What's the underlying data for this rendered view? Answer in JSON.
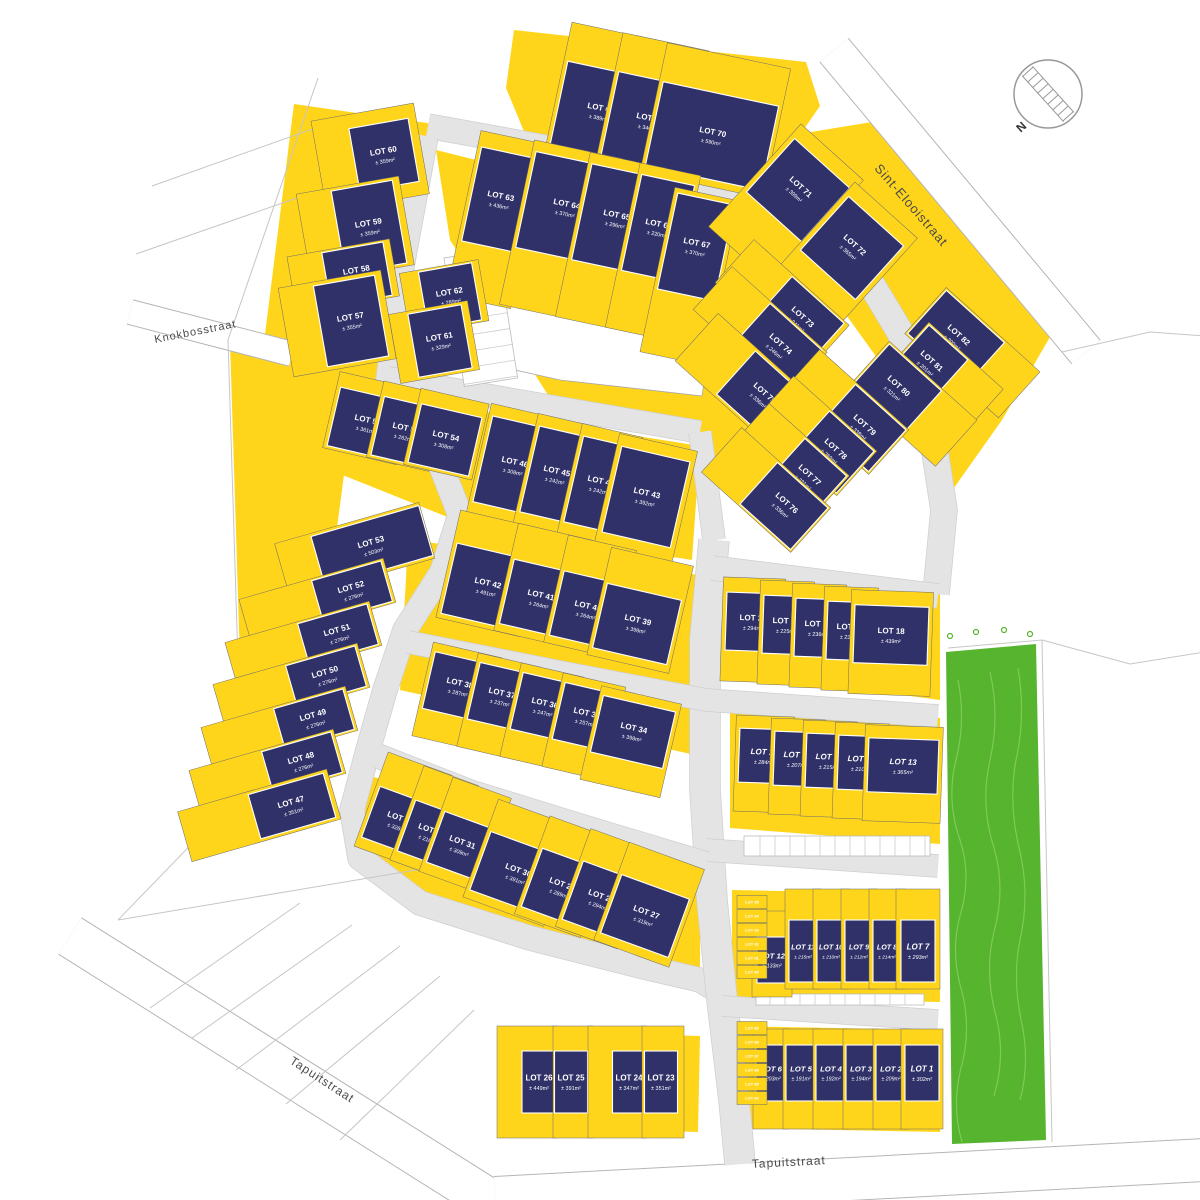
{
  "colors": {
    "parcel_yellow": "#FFD51C",
    "building_navy": "#303168",
    "road_gray": "#E4E4E4",
    "road_edge": "#CFCFCF",
    "street_white": "#FFFFFF",
    "street_edge": "#B5B5B5",
    "green_area": "#56B42E",
    "green_contour": "#7FCB58",
    "boundary_line": "#C6C6C6",
    "parcel_line": "#6B6B6B",
    "label_white": "#FFFFFF",
    "street_label": "#4A4A4A",
    "compass_stroke": "#999999"
  },
  "compass": {
    "label": "N"
  },
  "streets": [
    {
      "name": "Sint-Elooistraat",
      "x": 908,
      "y": 208,
      "angle": 49,
      "size": 13
    },
    {
      "name": "Knokbosstraat",
      "x": 196,
      "y": 335,
      "angle": -11,
      "size": 11
    },
    {
      "name": "Tapuitstraat",
      "x": 320,
      "y": 1083,
      "angle": 33,
      "size": 12
    },
    {
      "name": "Tapuitstraat",
      "x": 789,
      "y": 1166,
      "angle": -3,
      "size": 12
    }
  ],
  "blocks": [
    {
      "angle": 12,
      "ph": 132,
      "dy": -16,
      "lots": [
        {
          "n": "LOT 68",
          "area": "± 389m²",
          "cx": 600,
          "cy": 112,
          "bw": 84,
          "bh": 86,
          "pw": 92
        },
        {
          "n": "LOT 69",
          "area": "± 346m²",
          "cx": 649,
          "cy": 122,
          "bw": 80,
          "bh": 86,
          "pw": 88
        },
        {
          "n": "LOT 70",
          "area": "± 590m²",
          "cx": 712,
          "cy": 136,
          "bw": 118,
          "bh": 86,
          "pw": 126
        }
      ]
    },
    {
      "angle": -10,
      "dx": -14,
      "lots": [
        {
          "n": "LOT 60",
          "area": "± 359m²",
          "cx": 384,
          "cy": 155,
          "bw": 60,
          "bh": 64,
          "pw": 104,
          "ph": 92
        },
        {
          "n": "LOT 59",
          "area": "± 359m²",
          "cx": 369,
          "cy": 227,
          "bw": 62,
          "bh": 84,
          "pw": 104,
          "ph": 90
        },
        {
          "n": "LOT 58",
          "area": "± 271m²",
          "cx": 357,
          "cy": 274,
          "bw": 62,
          "bh": 54,
          "pw": 104,
          "ph": 58
        },
        {
          "n": "LOT 57",
          "area": "± 355m²",
          "cx": 351,
          "cy": 321,
          "bw": 62,
          "bh": 82,
          "pw": 104,
          "ph": 90
        }
      ]
    },
    {
      "angle": 12,
      "ph": 168,
      "lots": [
        {
          "n": "LOT 63",
          "area": "± 436m²",
          "cx": 500,
          "cy": 200,
          "bw": 58,
          "bh": 96,
          "pw": 66,
          "dy": 20
        },
        {
          "n": "LOT 64",
          "area": "± 370m²",
          "cx": 566,
          "cy": 208,
          "bw": 82,
          "bh": 98,
          "pw": 90,
          "dy": 24
        },
        {
          "n": "LOT 65",
          "area": "± 296m²",
          "cx": 616,
          "cy": 219,
          "bw": 70,
          "bh": 98,
          "pw": 78,
          "dy": 24
        },
        {
          "n": "LOT 66",
          "area": "± 220m²",
          "cx": 658,
          "cy": 228,
          "bw": 54,
          "bh": 98,
          "pw": 62,
          "dy": 24
        },
        {
          "n": "LOT 67",
          "area": "± 370m²",
          "cx": 696,
          "cy": 247,
          "bw": 58,
          "bh": 98,
          "pw": 66,
          "dy": 30
        }
      ]
    },
    {
      "angle": -10,
      "dx": -6,
      "lots": [
        {
          "n": "LOT 62",
          "area": "± 289m²",
          "cx": 450,
          "cy": 296,
          "bw": 54,
          "bh": 58,
          "pw": 80,
          "ph": 62
        },
        {
          "n": "LOT 61",
          "area": "± 329m²",
          "cx": 440,
          "cy": 341,
          "bw": 54,
          "bh": 64,
          "pw": 80,
          "ph": 70
        }
      ]
    },
    {
      "angle": 42,
      "dy": 18,
      "ph": 138,
      "lots": [
        {
          "n": "LOT 71",
          "area": "± 399m²",
          "cx": 798,
          "cy": 190,
          "bw": 74,
          "bh": 72,
          "pw": 84
        },
        {
          "n": "LOT 72",
          "area": "± 365m²",
          "cx": 852,
          "cy": 248,
          "bw": 74,
          "bh": 72,
          "pw": 84
        }
      ]
    },
    {
      "angle": 42,
      "dx": -24,
      "lots": [
        {
          "n": "LOT 73",
          "area": "± 341m²",
          "cx": 800,
          "cy": 320,
          "bw": 70,
          "bh": 54,
          "pw": 128,
          "ph": 58
        },
        {
          "n": "LOT 74",
          "area": "± 246m²",
          "cx": 778,
          "cy": 347,
          "bw": 70,
          "bh": 54,
          "pw": 128,
          "ph": 58
        },
        {
          "n": "LOT 75",
          "area": "± 336m²",
          "cx": 762,
          "cy": 396,
          "bw": 70,
          "bh": 58,
          "pw": 128,
          "ph": 64
        }
      ]
    },
    {
      "angle": 42,
      "dx": 22,
      "ph": 62,
      "lots": [
        {
          "n": "LOT 82",
          "area": "± 390m²",
          "cx": 956,
          "cy": 338,
          "bw": 78,
          "bh": 58,
          "pw": 126
        },
        {
          "n": "LOT 81",
          "area": "± 201m²",
          "cx": 929,
          "cy": 364,
          "bw": 52,
          "bh": 58,
          "pw": 100
        },
        {
          "n": "LOT 80",
          "area": "± 321m²",
          "cx": 896,
          "cy": 389,
          "bw": 70,
          "bh": 58,
          "pw": 118
        }
      ]
    },
    {
      "angle": 42,
      "dx": -24,
      "ph": 60,
      "lots": [
        {
          "n": "LOT 79",
          "area": "± 338m²",
          "cx": 862,
          "cy": 428,
          "bw": 68,
          "bh": 56,
          "pw": 120
        },
        {
          "n": "LOT 78",
          "area": "± 269m²",
          "cx": 833,
          "cy": 452,
          "bw": 60,
          "bh": 56,
          "pw": 112
        },
        {
          "n": "LOT 77",
          "area": "± 231m²",
          "cx": 807,
          "cy": 478,
          "bw": 56,
          "bh": 56,
          "pw": 108
        },
        {
          "n": "LOT 76",
          "area": "± 336m²",
          "cx": 784,
          "cy": 506,
          "bw": 68,
          "bh": 56,
          "pw": 120
        }
      ]
    },
    {
      "angle": 13,
      "dy": -6,
      "ph": 78,
      "lots": [
        {
          "n": "LOT 56",
          "area": "± 361m²",
          "cx": 367,
          "cy": 424,
          "bw": 68,
          "bh": 60,
          "pw": 76
        },
        {
          "n": "LOT 55",
          "area": "± 262m²",
          "cx": 405,
          "cy": 432,
          "bw": 56,
          "bh": 60,
          "pw": 64
        },
        {
          "n": "LOT 54",
          "area": "± 308m²",
          "cx": 445,
          "cy": 440,
          "bw": 62,
          "bh": 60,
          "pw": 70
        }
      ]
    },
    {
      "angle": 13,
      "dy": 14,
      "ph": 140,
      "lots": [
        {
          "n": "LOT 46",
          "area": "± 308m²",
          "cx": 514,
          "cy": 466,
          "bw": 64,
          "bh": 88,
          "pw": 72
        },
        {
          "n": "LOT 45",
          "area": "± 242m²",
          "cx": 556,
          "cy": 475,
          "bw": 54,
          "bh": 88,
          "pw": 62
        },
        {
          "n": "LOT 44",
          "area": "± 242m²",
          "cx": 600,
          "cy": 485,
          "bw": 54,
          "bh": 88,
          "pw": 62
        },
        {
          "n": "LOT 43",
          "area": "± 392m²",
          "cx": 646,
          "cy": 497,
          "bw": 70,
          "bh": 88,
          "pw": 80
        }
      ]
    },
    {
      "angle": -16,
      "lots": [
        {
          "n": "LOT 53",
          "area": "± 503m²",
          "cx": 372,
          "cy": 546,
          "bw": 112,
          "bh": 52,
          "pw": 150,
          "ph": 58,
          "dx": -18
        }
      ]
    },
    {
      "angle": -16,
      "dx": -36,
      "ph": 46,
      "lots": [
        {
          "n": "LOT 52",
          "area": "± 276m²",
          "cx": 352,
          "cy": 591,
          "bw": 72,
          "bh": 42,
          "pw": 150
        },
        {
          "n": "LOT 51",
          "area": "± 276m²",
          "cx": 338,
          "cy": 634,
          "bw": 72,
          "bh": 42,
          "pw": 150
        },
        {
          "n": "LOT 50",
          "area": "± 276m²",
          "cx": 326,
          "cy": 676,
          "bw": 72,
          "bh": 42,
          "pw": 150
        },
        {
          "n": "LOT 49",
          "area": "± 276m²",
          "cx": 314,
          "cy": 719,
          "bw": 72,
          "bh": 42,
          "pw": 150
        },
        {
          "n": "LOT 48",
          "area": "± 276m²",
          "cx": 302,
          "cy": 762,
          "bw": 72,
          "bh": 42,
          "pw": 150
        },
        {
          "n": "LOT 47",
          "area": "± 351m²",
          "cx": 292,
          "cy": 806,
          "bw": 78,
          "bh": 46,
          "pw": 155,
          "ph": 52,
          "dx": -34
        }
      ]
    },
    {
      "angle": 13,
      "dy": -14,
      "ph": 110,
      "lots": [
        {
          "n": "LOT 42",
          "area": "± 491m²",
          "cx": 487,
          "cy": 587,
          "bw": 78,
          "bh": 72,
          "pw": 86
        },
        {
          "n": "LOT 41",
          "area": "± 264m²",
          "cx": 540,
          "cy": 599,
          "bw": 68,
          "bh": 66,
          "pw": 76
        },
        {
          "n": "LOT 40",
          "area": "± 264m²",
          "cx": 587,
          "cy": 610,
          "bw": 62,
          "bh": 66,
          "pw": 70
        },
        {
          "n": "LOT 39",
          "area": "± 398m²",
          "cx": 637,
          "cy": 624,
          "bw": 76,
          "bh": 66,
          "pw": 84
        }
      ]
    },
    {
      "angle": 13,
      "dy": 10,
      "ph": 96,
      "lots": [
        {
          "n": "LOT 38",
          "area": "± 287m²",
          "cx": 459,
          "cy": 687,
          "bw": 62,
          "bh": 58,
          "pw": 70
        },
        {
          "n": "LOT 37",
          "area": "± 237m²",
          "cx": 501,
          "cy": 697,
          "bw": 56,
          "bh": 58,
          "pw": 64
        },
        {
          "n": "LOT 36",
          "area": "± 247m²",
          "cx": 544,
          "cy": 707,
          "bw": 56,
          "bh": 58,
          "pw": 64
        },
        {
          "n": "LOT 35",
          "area": "± 257m²",
          "cx": 586,
          "cy": 717,
          "bw": 56,
          "bh": 58,
          "pw": 64
        },
        {
          "n": "LOT 34",
          "area": "± 398m²",
          "cx": 633,
          "cy": 732,
          "bw": 74,
          "bh": 58,
          "pw": 82
        }
      ]
    },
    {
      "angle": 2,
      "dy": 8,
      "ph": 104,
      "lots": [
        {
          "n": "LOT 22",
          "area": "± 294m²",
          "cx": 753,
          "cy": 622,
          "bw": 54,
          "bh": 58,
          "pw": 62
        },
        {
          "n": "LOT 21",
          "area": "± 225m²",
          "cx": 786,
          "cy": 625,
          "bw": 46,
          "bh": 58,
          "pw": 54
        },
        {
          "n": "LOT 20",
          "area": "± 236m²",
          "cx": 818,
          "cy": 628,
          "bw": 46,
          "bh": 58,
          "pw": 54
        },
        {
          "n": "LOT 19",
          "area": "± 238m²",
          "cx": 850,
          "cy": 631,
          "bw": 46,
          "bh": 58,
          "pw": 54
        },
        {
          "n": "LOT 18",
          "area": "± 439m²",
          "cx": 891,
          "cy": 635,
          "bw": 74,
          "bh": 58,
          "pw": 82
        }
      ]
    },
    {
      "angle": 2,
      "it": 1,
      "dy": 8,
      "ph": 96,
      "lots": [
        {
          "n": "LOT 17",
          "area": "± 284m²",
          "cx": 764,
          "cy": 756,
          "bw": 50,
          "bh": 54,
          "pw": 58
        },
        {
          "n": "LOT 16",
          "area": "± 207m²",
          "cx": 797,
          "cy": 759,
          "bw": 46,
          "bh": 54,
          "pw": 54
        },
        {
          "n": "LOT 15",
          "area": "± 215m²",
          "cx": 829,
          "cy": 761,
          "bw": 46,
          "bh": 54,
          "pw": 54
        },
        {
          "n": "LOT 14",
          "area": "± 210m²",
          "cx": 861,
          "cy": 763,
          "bw": 46,
          "bh": 54,
          "pw": 54
        },
        {
          "n": "LOT 13",
          "area": "± 365m²",
          "cx": 903,
          "cy": 766,
          "bw": 70,
          "bh": 54,
          "pw": 78
        }
      ]
    },
    {
      "angle": 20,
      "dy": -12,
      "ph": 100,
      "lots": [
        {
          "n": "LOT 33",
          "area": "± 326m²",
          "cx": 399,
          "cy": 822,
          "bw": 60,
          "bh": 54,
          "pw": 68
        },
        {
          "n": "LOT 32",
          "area": "± 216m²",
          "cx": 430,
          "cy": 834,
          "bw": 50,
          "bh": 54,
          "pw": 58
        },
        {
          "n": "LOT 31",
          "area": "± 309m²",
          "cx": 461,
          "cy": 846,
          "bw": 54,
          "bh": 54,
          "pw": 62
        }
      ]
    },
    {
      "angle": 20,
      "dy": -12,
      "ph": 104,
      "lots": [
        {
          "n": "LOT 30",
          "area": "± 391m²",
          "cx": 517,
          "cy": 874,
          "bw": 78,
          "bh": 62,
          "pw": 86
        },
        {
          "n": "LOT 29",
          "area": "± 289m²",
          "cx": 561,
          "cy": 888,
          "bw": 62,
          "bh": 62,
          "pw": 70
        },
        {
          "n": "LOT 28",
          "area": "± 294m²",
          "cx": 600,
          "cy": 900,
          "bw": 58,
          "bh": 62,
          "pw": 66
        },
        {
          "n": "LOT 27",
          "area": "± 319m²",
          "cx": 645,
          "cy": 916,
          "bw": 72,
          "bh": 62,
          "pw": 80
        }
      ]
    },
    {
      "angle": 0,
      "it": 1,
      "dy": -12,
      "ph": 100,
      "lots": [
        {
          "n": "LOT 12",
          "area": "± 133m²",
          "cx": 772,
          "cy": 960,
          "bw": 30,
          "bh": 46,
          "pw": 40,
          "ph": 86,
          "dy": -6
        },
        {
          "n": "LOT 11",
          "area": "± 215m²",
          "cx": 803,
          "cy": 951,
          "bw": 28,
          "bh": 62,
          "pw": 36
        },
        {
          "n": "LOT 10",
          "area": "± 210m²",
          "cx": 831,
          "cy": 951,
          "bw": 28,
          "bh": 62,
          "pw": 36
        },
        {
          "n": "LOT 9",
          "area": "± 212m²",
          "cx": 859,
          "cy": 951,
          "bw": 28,
          "bh": 62,
          "pw": 36
        },
        {
          "n": "LOT 8",
          "area": "± 214m²",
          "cx": 887,
          "cy": 951,
          "bw": 28,
          "bh": 62,
          "pw": 36
        },
        {
          "n": "LOT 7",
          "area": "± 293m²",
          "cx": 918,
          "cy": 951,
          "bw": 34,
          "bh": 62,
          "pw": 44
        }
      ]
    },
    {
      "angle": 0,
      "ph": 112,
      "lots": [
        {
          "n": "LOT 26",
          "area": "± 449m²",
          "cx": 539,
          "cy": 1082,
          "bw": 34,
          "bh": 62,
          "pw": 60,
          "dx": -12
        },
        {
          "n": "LOT 25",
          "area": "± 391m²",
          "cx": 571,
          "cy": 1082,
          "bw": 33,
          "bh": 62,
          "pw": 40,
          "dx": 2
        },
        {
          "n": "LOT 24",
          "area": "± 347m²",
          "cx": 629,
          "cy": 1082,
          "bw": 33,
          "bh": 62,
          "pw": 58,
          "dx": -12
        },
        {
          "n": "LOT 23",
          "area": "± 351m²",
          "cx": 661,
          "cy": 1082,
          "bw": 33,
          "bh": 62,
          "pw": 42,
          "dx": 2
        }
      ]
    },
    {
      "angle": 0,
      "it": 1,
      "dy": 6,
      "ph": 100,
      "lots": [
        {
          "n": "LOT 6",
          "area": "± 203m²",
          "cx": 771,
          "cy": 1073,
          "bw": 30,
          "bh": 56,
          "pw": 36
        },
        {
          "n": "LOT 5",
          "area": "± 191m²",
          "cx": 801,
          "cy": 1073,
          "bw": 30,
          "bh": 56,
          "pw": 36
        },
        {
          "n": "LOT 4",
          "area": "± 192m²",
          "cx": 831,
          "cy": 1073,
          "bw": 30,
          "bh": 56,
          "pw": 36
        },
        {
          "n": "LOT 3",
          "area": "± 194m²",
          "cx": 861,
          "cy": 1073,
          "bw": 30,
          "bh": 56,
          "pw": 36
        },
        {
          "n": "LOT 2",
          "area": "± 209m²",
          "cx": 891,
          "cy": 1073,
          "bw": 30,
          "bh": 56,
          "pw": 36
        },
        {
          "n": "LOT 1",
          "area": "± 302m²",
          "cx": 922,
          "cy": 1073,
          "bw": 34,
          "bh": 56,
          "pw": 42
        }
      ]
    }
  ],
  "garages": [
    {
      "n": "LOT 95",
      "cx": 752,
      "cy": 902
    },
    {
      "n": "LOT 94",
      "cx": 752,
      "cy": 916
    },
    {
      "n": "LOT 93",
      "cx": 752,
      "cy": 930
    },
    {
      "n": "LOT 92",
      "cx": 752,
      "cy": 944
    },
    {
      "n": "LOT 91",
      "cx": 752,
      "cy": 958
    },
    {
      "n": "LOT 90",
      "cx": 752,
      "cy": 972
    },
    {
      "n": "LOT 89",
      "cx": 752,
      "cy": 1028
    },
    {
      "n": "LOT 88",
      "cx": 752,
      "cy": 1042
    },
    {
      "n": "LOT 87",
      "cx": 752,
      "cy": 1056
    },
    {
      "n": "LOT 86",
      "cx": 752,
      "cy": 1070
    },
    {
      "n": "LOT 85",
      "cx": 752,
      "cy": 1084
    },
    {
      "n": "LOT 84",
      "cx": 752,
      "cy": 1098
    }
  ]
}
